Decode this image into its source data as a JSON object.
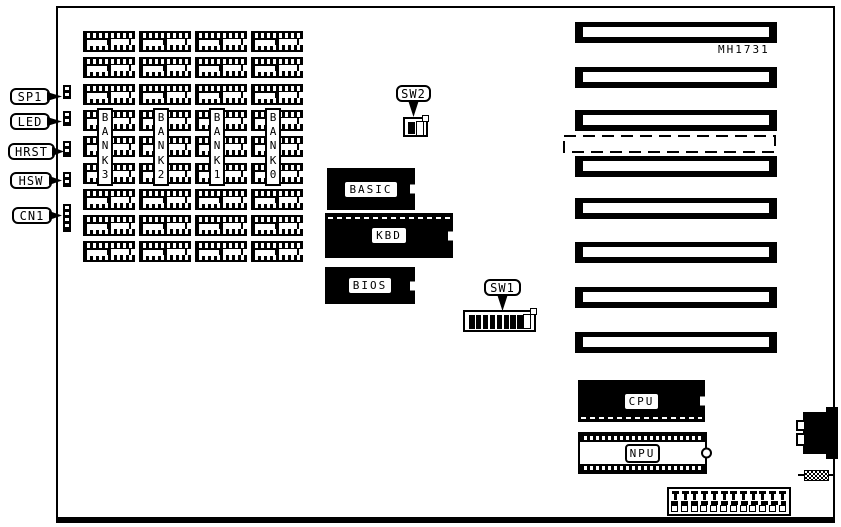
{
  "board": {
    "model": "MH1731",
    "left_connectors": [
      {
        "label": "SP1"
      },
      {
        "label": "LED"
      },
      {
        "label": "HRST"
      },
      {
        "label": "HSW"
      },
      {
        "label": "CN1"
      }
    ],
    "memory_banks": [
      {
        "label": "BANK3"
      },
      {
        "label": "BANK2"
      },
      {
        "label": "BANK1"
      },
      {
        "label": "BANK0"
      }
    ],
    "memory": {
      "chips_per_bank": 9
    },
    "rom_chips": [
      {
        "label": "BASIC"
      },
      {
        "label": "KBD"
      },
      {
        "label": "BIOS"
      }
    ],
    "switches": [
      {
        "label": "SW2",
        "black_positions": 1,
        "white_positions": 1
      },
      {
        "label": "SW1",
        "black_positions": 8,
        "white_positions": 1
      }
    ],
    "processors": [
      {
        "label": "CPU"
      },
      {
        "label": "NPU"
      }
    ],
    "expansion_slots": {
      "count": 8,
      "has_dashed_slot": true
    },
    "bottom_connector": {
      "top_pins": 12,
      "bottom_pins": 12
    },
    "colors": {
      "foreground": "#000000",
      "background": "#ffffff"
    }
  }
}
